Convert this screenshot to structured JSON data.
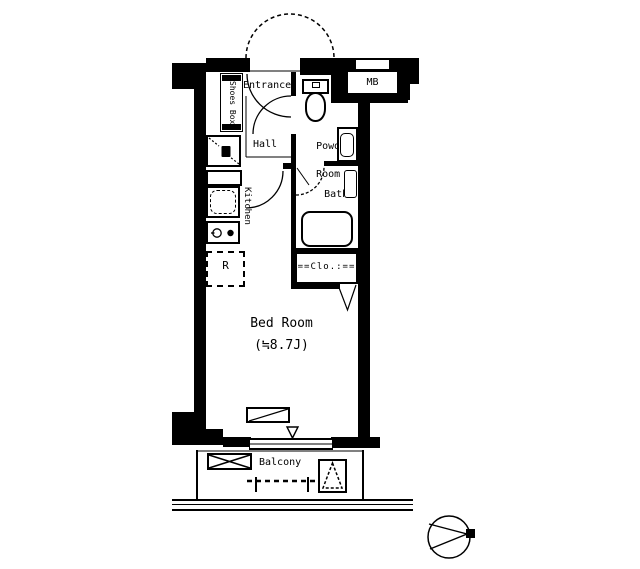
{
  "floorplan": {
    "rooms": {
      "entrance": "Entrance",
      "shoes_box": "Shoes Box",
      "hall": "Hall",
      "powder_line1": "Powder",
      "powder_line2": "Room",
      "bath_line1": "Bath",
      "bath_line2": "1116",
      "kitchen": "Kitchen",
      "refrigerator": "R",
      "closet": "==Clo.:==",
      "bedroom_line1": "Bed Room",
      "bedroom_line2": "(≒8.7J)",
      "balcony": "Balcony",
      "meter_box": "MB"
    },
    "colors": {
      "line": "#000000",
      "background": "#ffffff"
    }
  }
}
